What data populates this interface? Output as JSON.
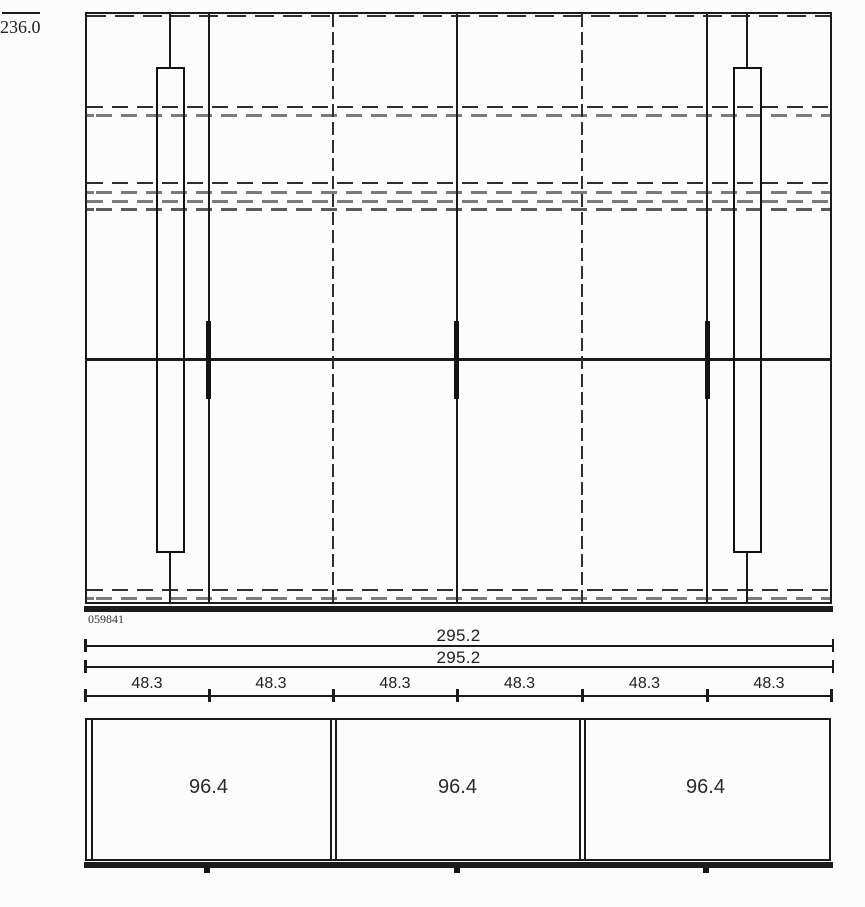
{
  "meta": {
    "type": "furniture-technical-drawing",
    "views": [
      "front-elevation",
      "top-plan"
    ]
  },
  "labels": {
    "height": "236.0",
    "drawing_number": "059841",
    "overall_width_1": "295.2",
    "overall_width_2": "295.2",
    "door_widths": [
      "48.3",
      "48.3",
      "48.3",
      "48.3",
      "48.3",
      "48.3"
    ],
    "module_widths": [
      "96.4",
      "96.4",
      "96.4"
    ]
  },
  "colors": {
    "line": "#1b1b1b",
    "dash_dark": "#2e2e2e",
    "dash_gray": "#7b7b7b",
    "background": "#fcfcfc"
  }
}
